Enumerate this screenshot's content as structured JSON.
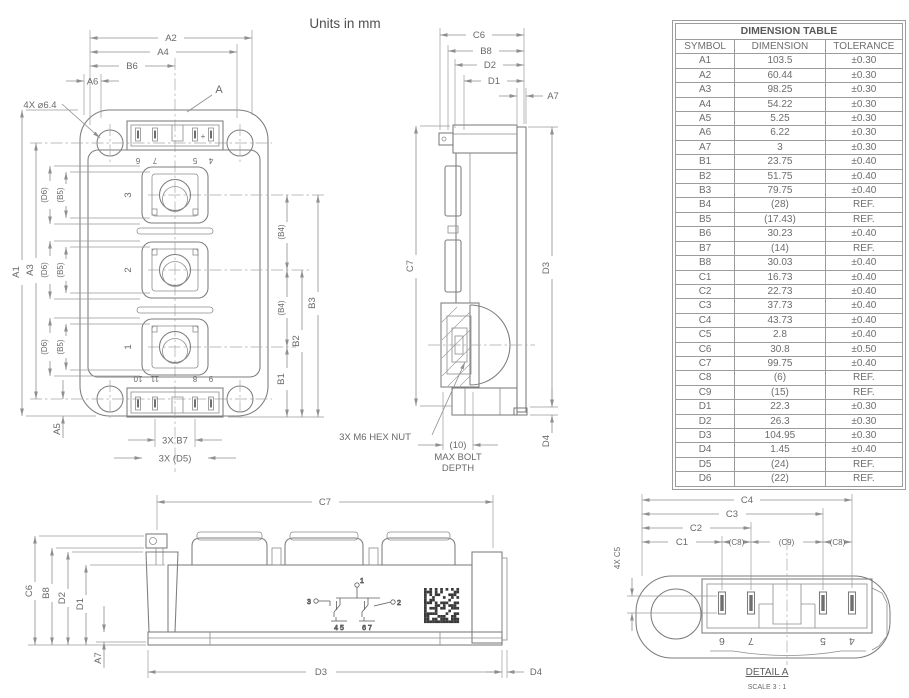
{
  "title": "Units in mm",
  "table": {
    "title": "DIMENSION TABLE",
    "columns": [
      "SYMBOL",
      "DIMENSION",
      "TOLERANCE"
    ],
    "rows": [
      [
        "A1",
        "103.5",
        "±0.30"
      ],
      [
        "A2",
        "60.44",
        "±0.30"
      ],
      [
        "A3",
        "98.25",
        "±0.30"
      ],
      [
        "A4",
        "54.22",
        "±0.30"
      ],
      [
        "A5",
        "5.25",
        "±0.30"
      ],
      [
        "A6",
        "6.22",
        "±0.30"
      ],
      [
        "A7",
        "3",
        "±0.30"
      ],
      [
        "B1",
        "23.75",
        "±0.40"
      ],
      [
        "B2",
        "51.75",
        "±0.40"
      ],
      [
        "B3",
        "79.75",
        "±0.40"
      ],
      [
        "B4",
        "(28)",
        "REF."
      ],
      [
        "B5",
        "(17.43)",
        "REF."
      ],
      [
        "B6",
        "30.23",
        "±0.40"
      ],
      [
        "B7",
        "(14)",
        "REF."
      ],
      [
        "B8",
        "30.03",
        "±0.40"
      ],
      [
        "C1",
        "16.73",
        "±0.40"
      ],
      [
        "C2",
        "22.73",
        "±0.40"
      ],
      [
        "C3",
        "37.73",
        "±0.40"
      ],
      [
        "C4",
        "43.73",
        "±0.40"
      ],
      [
        "C5",
        "2.8",
        "±0.40"
      ],
      [
        "C6",
        "30.8",
        "±0.50"
      ],
      [
        "C7",
        "99.75",
        "±0.40"
      ],
      [
        "C8",
        "(6)",
        "REF."
      ],
      [
        "C9",
        "(15)",
        "REF."
      ],
      [
        "D1",
        "22.3",
        "±0.30"
      ],
      [
        "D2",
        "26.3",
        "±0.30"
      ],
      [
        "D3",
        "104.95",
        "±0.30"
      ],
      [
        "D4",
        "1.45",
        "±0.40"
      ],
      [
        "D5",
        "(24)",
        "REF."
      ],
      [
        "D6",
        "(22)",
        "REF."
      ]
    ]
  },
  "front_view": {
    "dim_a1": "A1",
    "dim_a2": "A2",
    "dim_a3": "A3",
    "dim_a4": "A4",
    "dim_a5": "A5",
    "dim_a6": "A6",
    "dim_b6": "B6",
    "dim_d6": "(D6)",
    "dim_b5": "(B5)",
    "dim_b4": "(B4)",
    "dim_b1": "B1",
    "dim_b2": "B2",
    "dim_b3": "B3",
    "dim_b7": "3X B7",
    "dim_d5": "3X (D5)",
    "callout_a": "A",
    "holes_note": "4X ⌀6.4",
    "plus_mark": "+",
    "terminals": [
      "3",
      "2",
      "1"
    ],
    "pins_top": [
      "6",
      "7",
      "5",
      "4"
    ],
    "pins_bottom": [
      "10",
      "11",
      "8",
      "9"
    ]
  },
  "side_view": {
    "dim_c6": "C6",
    "dim_b8": "B8",
    "dim_d2": "D2",
    "dim_d1": "D1",
    "dim_a7": "A7",
    "dim_c7": "C7",
    "dim_d3": "D3",
    "dim_d4": "D4",
    "hex_nut_note": "3X M6 HEX NUT",
    "bolt_depth": [
      "(10)",
      "MAX BOLT",
      "DEPTH"
    ]
  },
  "bottom_view": {
    "dim_c7": "C7",
    "dim_c6": "C6",
    "dim_b8": "B8",
    "dim_d2": "D2",
    "dim_d1": "D1",
    "dim_a7": "A7",
    "dim_d3": "D3",
    "dim_d4": "D4",
    "schematic": {
      "t1": "1",
      "t2": "2",
      "t3": "3",
      "g_left": "4  5",
      "g_right": "6  7"
    }
  },
  "detail_view": {
    "dim_c4": "C4",
    "dim_c3": "C3",
    "dim_c2": "C2",
    "dim_c1": "C1",
    "dim_c8": "(C8)",
    "dim_c9": "(C9)",
    "dim_c5": "4X C5",
    "pins": [
      "6",
      "7",
      "5",
      "4"
    ],
    "caption": "DETAIL A",
    "scale": "SCALE 3 : 1"
  }
}
